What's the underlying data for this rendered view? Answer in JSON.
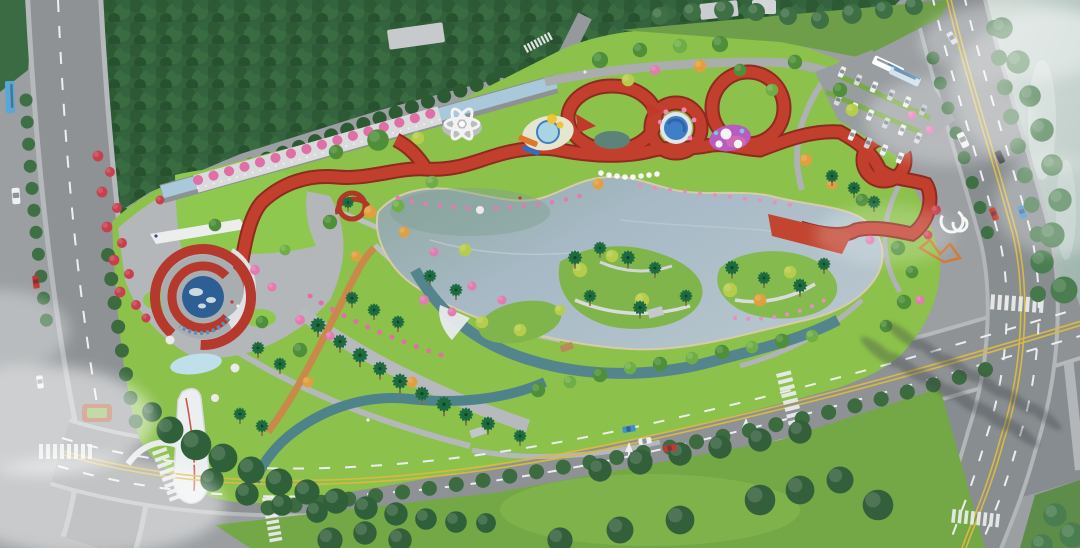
{
  "scene": {
    "description": "Aerial architectural rendering of a city park master plan: a red looping elevated ribbon walkway over water playgrounds, a central lake with palm-planted islands, a red spiral visitor pavilion with a world-map pond, a white sail gateway sculpture, a canal-side pergola corridor, a dense forest belt, perimeter roads with traffic and crosswalks, a surface parking lot with buses, and a river along the north-east edge.",
    "palette": {
      "ribbon_red": "#c23f2e",
      "ribbon_dark": "#8e2a20",
      "lawn_green": "#8cc14b",
      "verge_green": "#74a746",
      "forest_green": "#33613b",
      "lake_blue": "#a6b9c5",
      "canal_blue": "#a9c9db",
      "stream_teal": "#4f838a",
      "road_gray": "#8e9295",
      "plaza_gray": "#878c90",
      "paving_light": "#b3b7b9",
      "gravel_orange": "#c9894a",
      "flower_pink": "#e06fa6",
      "flowering_red": "#c8404e",
      "autumn_orange": "#e0a03f",
      "play_purple": "#b85cc0",
      "pool_blue": "#3f7fc5",
      "sculpture_white": "#f0f2f2"
    },
    "features": [
      {
        "id": "red-ribbon-walkway",
        "label": "Looping elevated red ribbon walkway with slides"
      },
      {
        "id": "central-lake",
        "label": "Central lake with planted palm islands"
      },
      {
        "id": "spiral-pavilion",
        "label": "Red spiral pavilion around a world-map pond"
      },
      {
        "id": "water-playgrounds",
        "label": "Children's water playground pools and purple play mat"
      },
      {
        "id": "flower-sculpture",
        "label": "White flower lattice sculpture"
      },
      {
        "id": "sail-sculpture",
        "label": "White sail gateway sculpture"
      },
      {
        "id": "pergola-corridor",
        "label": "Canal-side pergola corridor with pink blossom trees"
      },
      {
        "id": "entry-lawn",
        "label": "North-west entry plaza with curved lawn"
      },
      {
        "id": "parking-lot",
        "label": "Surface parking lot with buses and cars"
      },
      {
        "id": "perimeter-roads",
        "label": "Perimeter roads with lane markings, crosswalks and traffic"
      },
      {
        "id": "riverside",
        "label": "Misty river along the north-east edge"
      },
      {
        "id": "forest-belt",
        "label": "Dense forest belt along the north-west edge"
      },
      {
        "id": "south-plaza",
        "label": "Large paved plaza with tree shadows, south-east corner"
      }
    ],
    "vehicles": {
      "buses": 3,
      "street_cars": 11,
      "parked_cars": 16
    }
  }
}
